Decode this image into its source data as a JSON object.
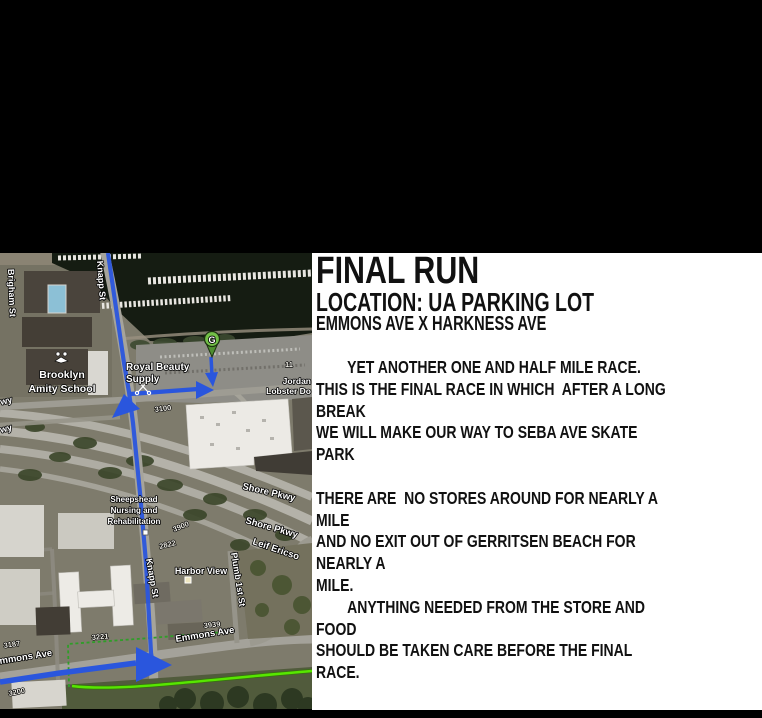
{
  "flyer": {
    "title": "FINAL RUN",
    "subtitle": "LOCATION: UA PARKING LOT",
    "subtitle2": "EMMONS AVE X HARKNESS AVE",
    "lines": [
      "        YET ANOTHER ONE AND HALF MILE RACE.",
      "THIS IS THE FINAL RACE IN WHICH  AFTER A LONG BREAK",
      "WE WILL MAKE OUR WAY TO SEBA AVE SKATE PARK",
      "",
      "THERE ARE  NO STORES AROUND FOR NEARLY A MILE",
      "AND NO EXIT OUT OF GERRITSEN BEACH FOR NEARLY A",
      "MILE.",
      "        ANYTHING NEEDED FROM THE STORE AND FOOD",
      "SHOULD BE TAKEN CARE BEFORE THE FINAL RACE."
    ]
  },
  "map": {
    "pin_letter": "G",
    "labels": {
      "knapp_st_top": "Knapp St",
      "knapp_st_bottom": "Knapp St",
      "brigham_st": "Brigham St",
      "brooklyn_line1": "Brooklyn",
      "brooklyn_line2": "Amity School",
      "royal_line1": "Royal Beauty",
      "royal_line2": "Supply",
      "jordan_line1": "Jordan",
      "jordan_line2": "Lobster Do",
      "num_11": "11",
      "sheepshead_line1": "Sheepshead",
      "sheepshead_line2": "Nursing and",
      "sheepshead_line3": "Rehabilitation",
      "shore_pkwy_1": "Shore Pkwy",
      "shore_pkwy_2": "Shore Pkwy",
      "leif_ericson": "Leif Ericso",
      "plumb_1st_st": "Plumb 1st St",
      "harbor_view": "Harbor View",
      "emmons_ave": "Emmons Ave",
      "emmons_ave_left": "mmons Ave",
      "wy_1": "wy",
      "wy_2": "wy",
      "addr_3100": "3100",
      "addr_3900": "3900",
      "addr_2822": "2822",
      "addr_3221": "3221",
      "addr_3187": "3187",
      "addr_3200": "3200",
      "addr_3939": "3939"
    },
    "colors": {
      "route_blue": "#2a56dd",
      "race_line_green": "#57e600",
      "walk_dashed_green": "#2f9e28",
      "pin_green": "#72bf47"
    }
  }
}
